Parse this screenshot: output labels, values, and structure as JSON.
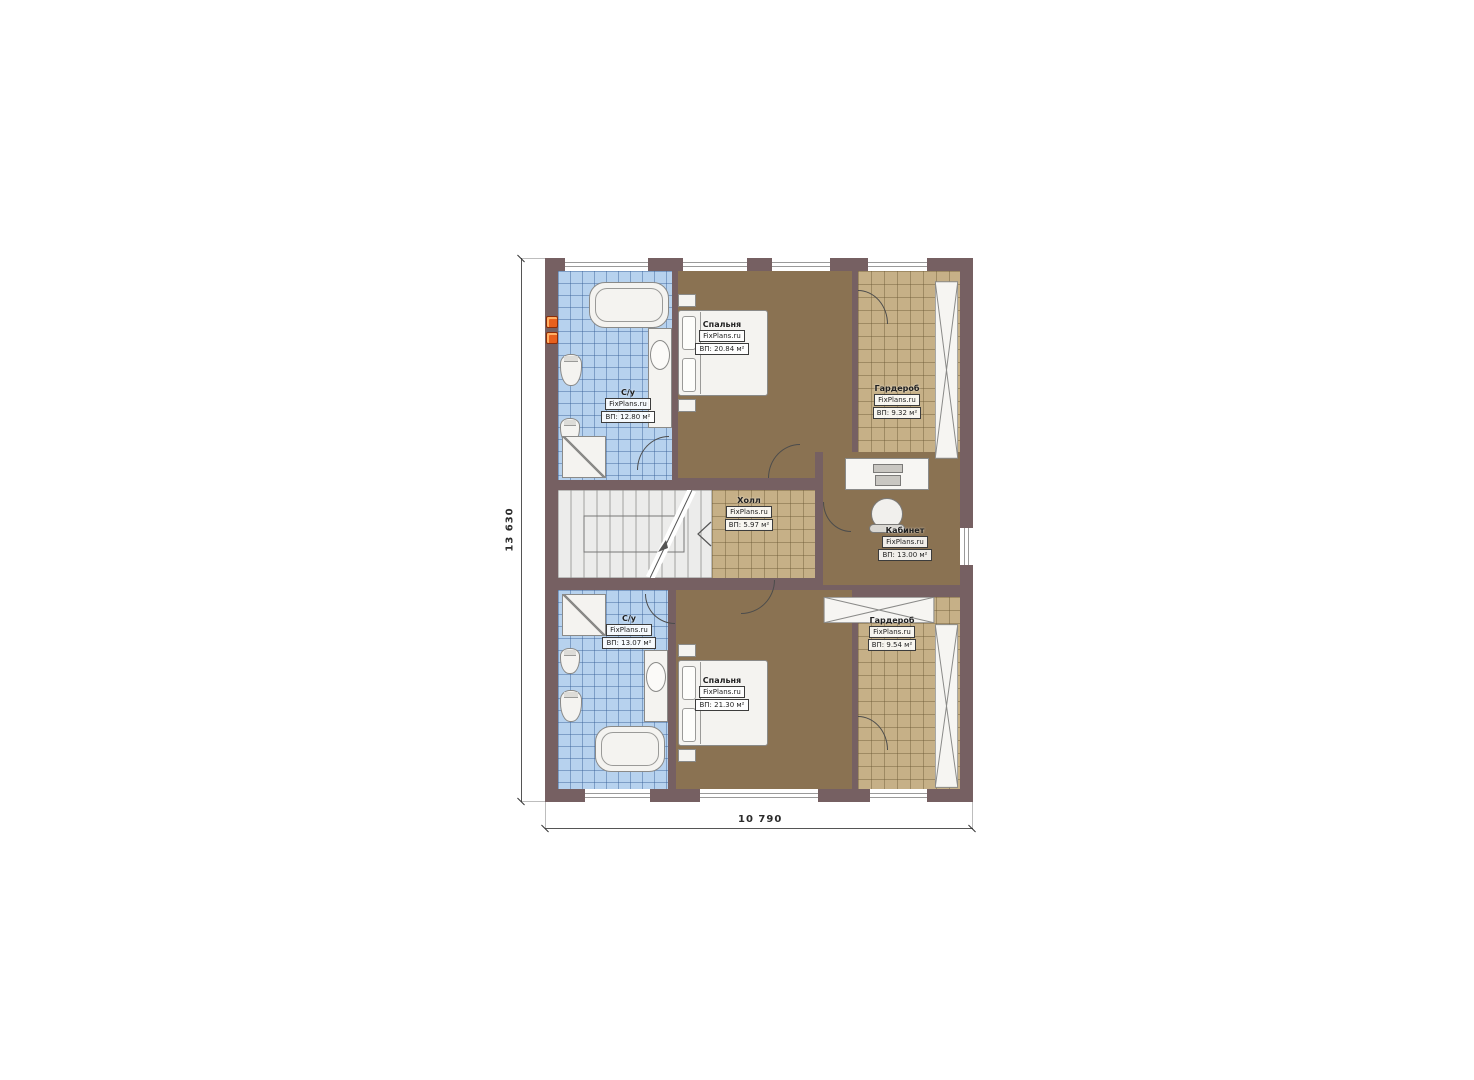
{
  "plan": {
    "dim_height": "13 630",
    "dim_width": "10 790",
    "rooms": [
      {
        "name": "С/у",
        "brand": "FixPlans.ru",
        "area": "ВП: 12.80 м²"
      },
      {
        "name": "Спальня",
        "brand": "FixPlans.ru",
        "area": "ВП: 20.84 м²"
      },
      {
        "name": "Гардероб",
        "brand": "FixPlans.ru",
        "area": "ВП: 9.32 м²"
      },
      {
        "name": "Холл",
        "brand": "FixPlans.ru",
        "area": "ВП: 5.97 м²"
      },
      {
        "name": "Кабинет",
        "brand": "FixPlans.ru",
        "area": "ВП: 13.00 м²"
      },
      {
        "name": "С/у",
        "brand": "FixPlans.ru",
        "area": "ВП: 13.07 м²"
      },
      {
        "name": "Спальня",
        "brand": "FixPlans.ru",
        "area": "ВП: 21.30 м²"
      },
      {
        "name": "Гардероб",
        "brand": "FixPlans.ru",
        "area": "ВП: 9.54 м²"
      }
    ],
    "colors": {
      "wall": "#766062",
      "tile_blue": "#b7d2ee",
      "floor_brown": "#8a7252",
      "floor_tan": "#c6b087",
      "heater": "#e8601e"
    }
  }
}
